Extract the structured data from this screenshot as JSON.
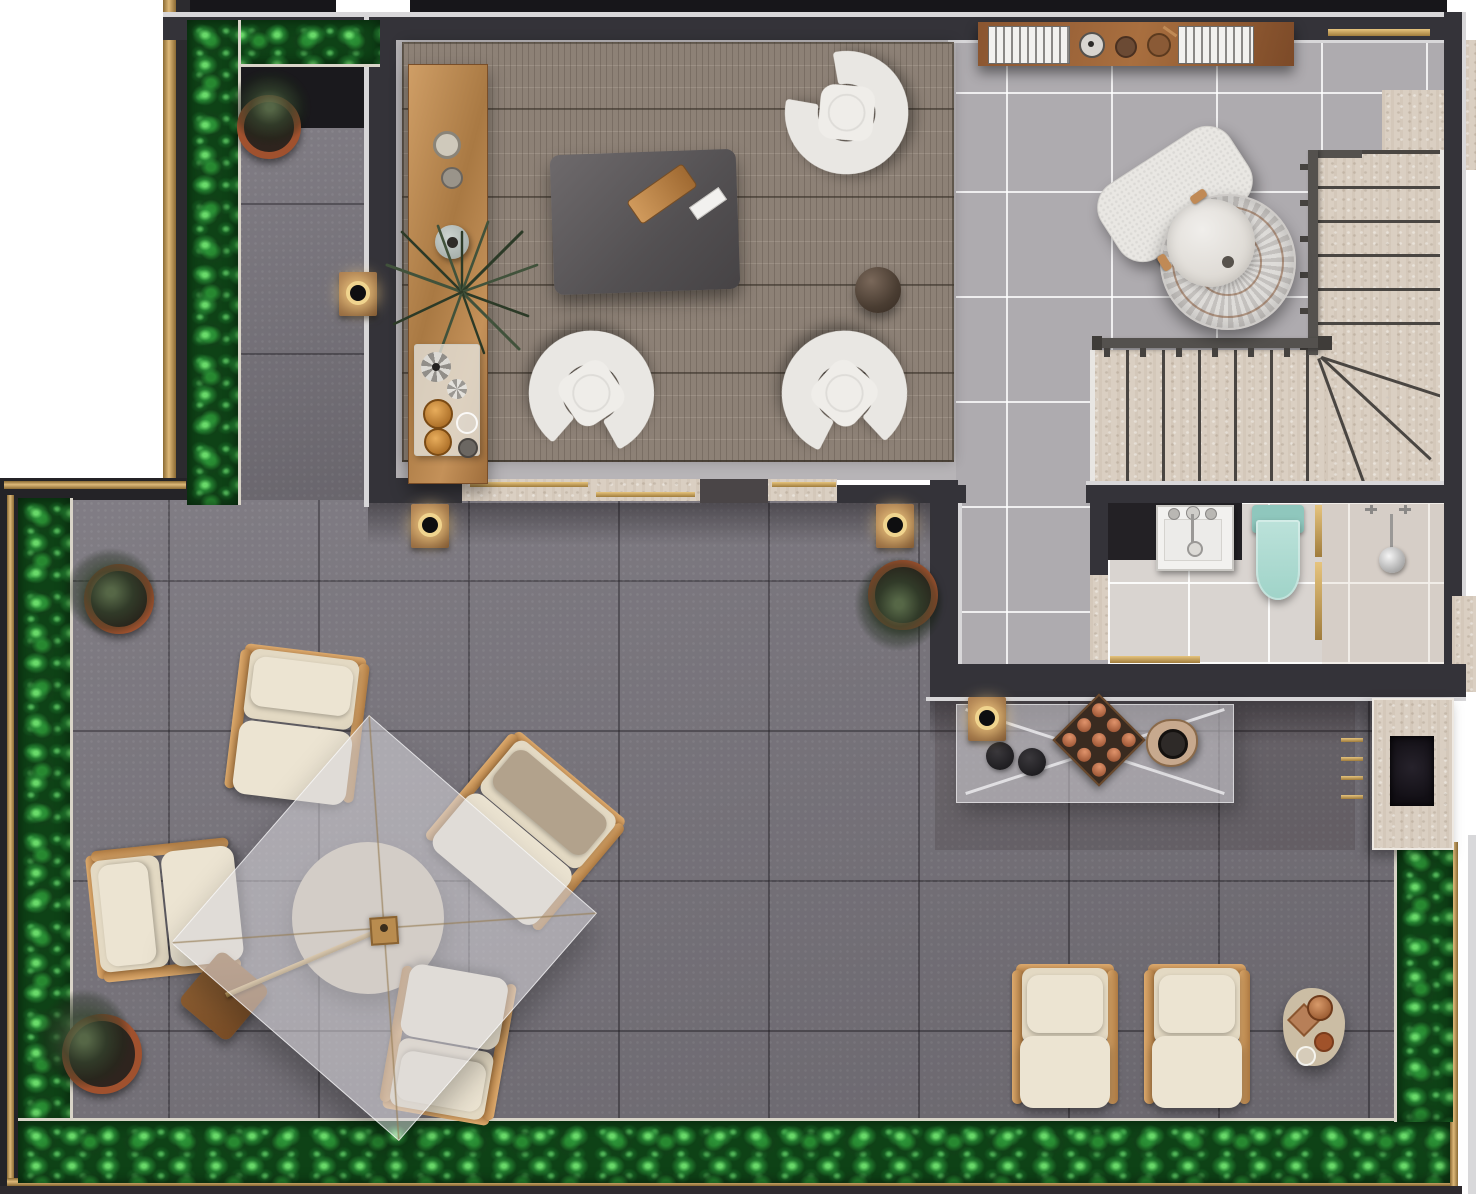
{
  "meta": {
    "description": "Top-down 3D rendered floor plan of a penthouse level with living room, stair hall, bathroom and large roof terrace"
  },
  "colors": {
    "bg": "#ffffff",
    "paver": "#79757d",
    "tile": "#aeabaf",
    "bathTile": "#d9d4d0",
    "wall": "#343339",
    "wallTrim": "#d8d7d9",
    "brass": "#c09a58",
    "travertine": "#dacfc2",
    "hedgeBase": "#0e4216",
    "hedgeMid": "#2e9a3c",
    "hedgeLight": "#5cc763",
    "wood": "#c08a56",
    "woodDark": "#8a5a36",
    "rug": "#8d8176",
    "boucle": "#e9e7e3",
    "cream": "#ece4d2",
    "creamDeep": "#e3d9c3",
    "taupe": "#b2a28c",
    "coffee": "#5c5859",
    "mint": "#aadbd2",
    "mintDark": "#8fc7bd",
    "counter": "#232125",
    "chrome": "#cfcdc9",
    "glass": "rgba(215,214,219,0.55)",
    "planterDark": "#1a191d",
    "white": "#f2f1ef"
  },
  "scene": {
    "areas": [
      {
        "id": "living-room",
        "name": "living room",
        "items": [
          "woven area rug",
          "wooden console with vases, palm and drinks tray",
          "dark coffee table with wooden tray",
          "three white boucle horseshoe armchairs",
          "round dark pouf"
        ]
      },
      {
        "id": "stair-hall",
        "name": "stair hall",
        "items": [
          "wall shelf with books and decor",
          "brass wall rail",
          "white boucle ottoman",
          "round woven swivel chair",
          "L-shaped travertine staircase with dark railing"
        ]
      },
      {
        "id": "bathroom",
        "name": "bathroom",
        "items": [
          "black vanity counter with white sink",
          "mint green toilet",
          "brass framed glass partition",
          "walk-in shower with round rain head"
        ]
      },
      {
        "id": "terrace",
        "name": "roof terrace",
        "items": [
          "round dining table under translucent square parasol",
          "four teak dining armchairs with cream cushions",
          "parasol base plate and pole",
          "glass outdoor bar table with X legs, plates and copper cups",
          "travertine outdoor fireplace with brass slats",
          "two teak lounge chairs with cream cushions",
          "organic side table with copper cups",
          "perimeter hedge planters with gold trim",
          "potted olive trees",
          "round gold wall lights"
        ]
      }
    ]
  }
}
